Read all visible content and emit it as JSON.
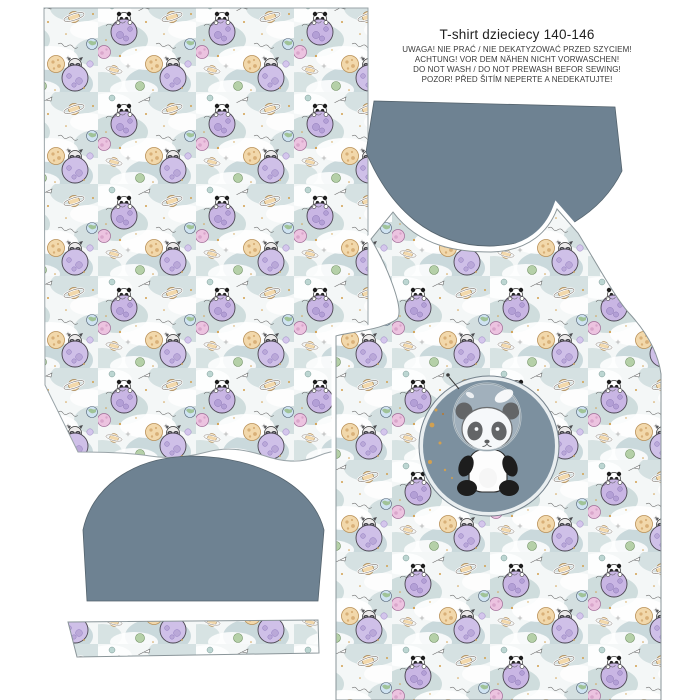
{
  "header": {
    "title": "T-shirt  dzieciecy 140-146",
    "care_lines": [
      "UWAGA! NIE PRAĆ / NIE DEKATYZOWAĆ PRZED SZYCIEM!",
      "ACHTUNG! VOR DEM NÄHEN NICHT VORWASCHEN!",
      "DO NOT WASH / DO NOT PREWASH BEFOR SEWING!",
      "POZOR! PŘED ŠITÍM NEPERTE A NEDEKATUJTE!"
    ]
  },
  "colors": {
    "background": "#ffffff",
    "solid_fabric": "#6e8292",
    "badge_disc": "#7c909f",
    "badge_ring": "#e9eef0",
    "piece_outline": "#8a9599",
    "cloud_teal": "#c9d8d9",
    "cloud_teal_dark": "#bccfd2",
    "planet_purple": "#c9b6e4",
    "planet_lavender": "#cfc0e8",
    "planet_peach": "#f2d8ab",
    "planet_pink": "#ecc3e0",
    "planet_green": "#b5d0a8",
    "planet_earth": "#cfe3f2",
    "gold_speckle": "#d2a050",
    "panda_black": "#1d1d1d",
    "panda_white": "#fdfdfd"
  }
}
